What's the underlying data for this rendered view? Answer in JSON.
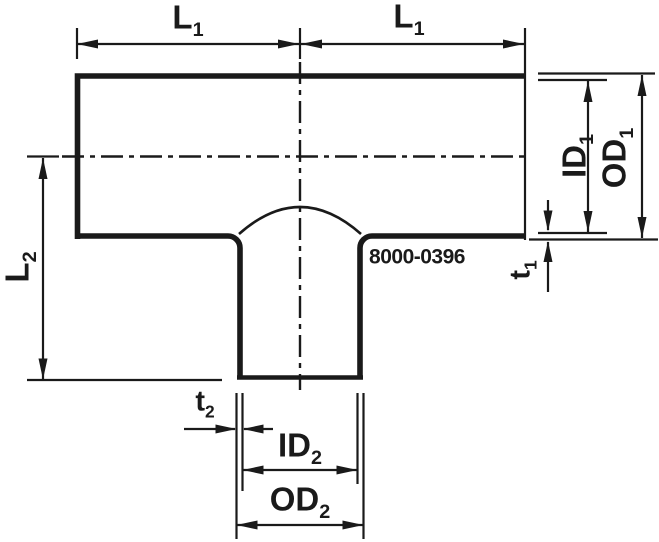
{
  "drawing": {
    "title": "tee-fitting-dimensional-diagram",
    "background_color": "#ffffff",
    "line_color": "#1a1a1a",
    "part_number": "8000-0396",
    "dimensions": {
      "l1_left": {
        "base": "L",
        "sub": "1"
      },
      "l1_right": {
        "base": "L",
        "sub": "1"
      },
      "l2": {
        "base": "L",
        "sub": "2"
      },
      "id1": {
        "base": "ID",
        "sub": "1"
      },
      "od1": {
        "base": "OD",
        "sub": "1"
      },
      "t1": {
        "base": "t",
        "sub": "1"
      },
      "t2": {
        "base": "t",
        "sub": "2"
      },
      "id2": {
        "base": "ID",
        "sub": "2"
      },
      "od2": {
        "base": "OD",
        "sub": "2"
      }
    }
  }
}
